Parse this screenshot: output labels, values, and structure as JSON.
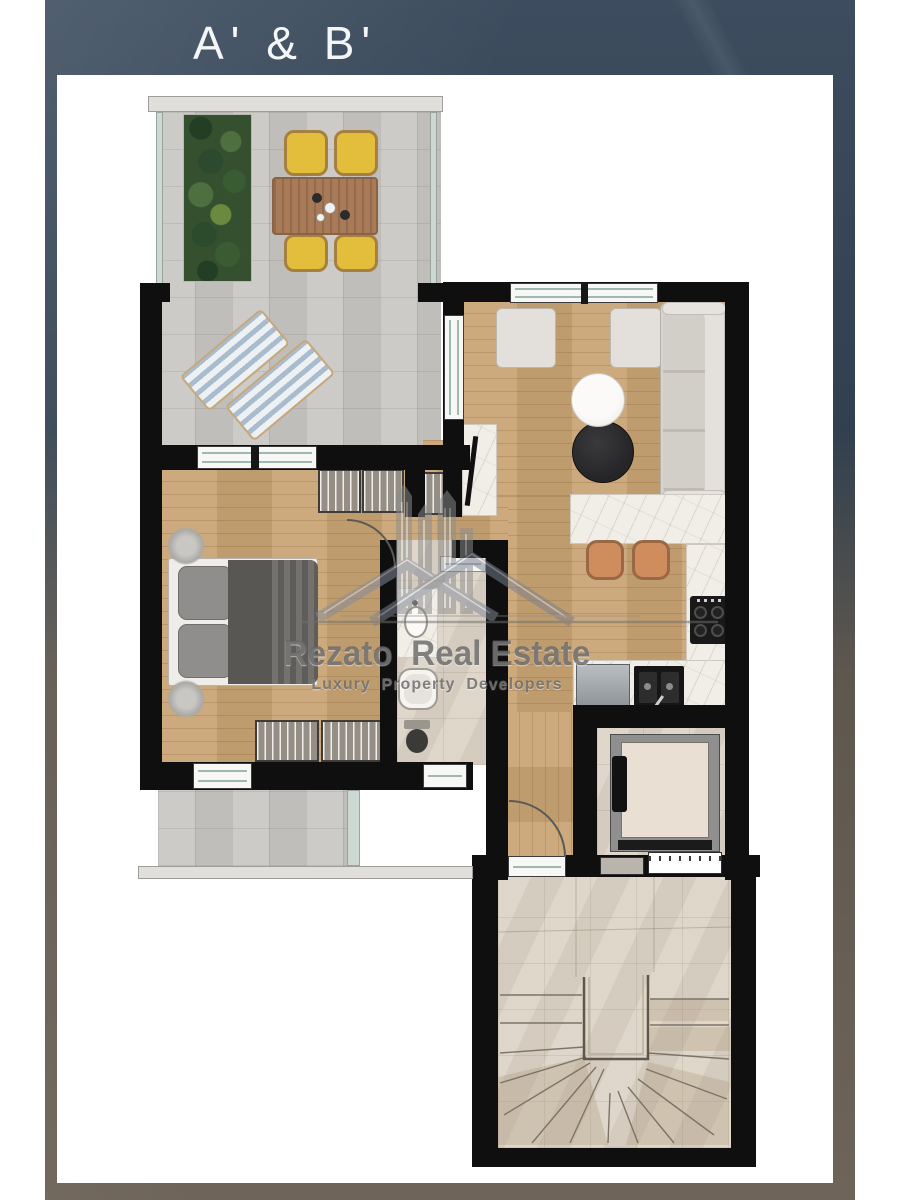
{
  "header": {
    "title": "A' & B'"
  },
  "watermark": {
    "brand": "Rezato  Real Estate",
    "tagline": "Luxury  Property  Developers"
  },
  "palette": {
    "frame_top": "#37475a",
    "frame_bottom": "#6e6459",
    "wall_black": "#0f0f0f",
    "wood_floor": "#c9a473",
    "terrace_tile": "#c9c8c4",
    "bathroom_tile": "#dbd2c4",
    "stair_tile": "#dbd2c4",
    "counter_marble": "#f1eee8",
    "sofa_gray": "#dcd8d2",
    "chair_yellow": "#e3bd3c",
    "table_brown": "#a87a57",
    "stool_terracotta": "#cf8d5e",
    "plant_green": "#35502f",
    "glass_teal": "#9fb8b2",
    "watermark_gray": "#666666"
  }
}
